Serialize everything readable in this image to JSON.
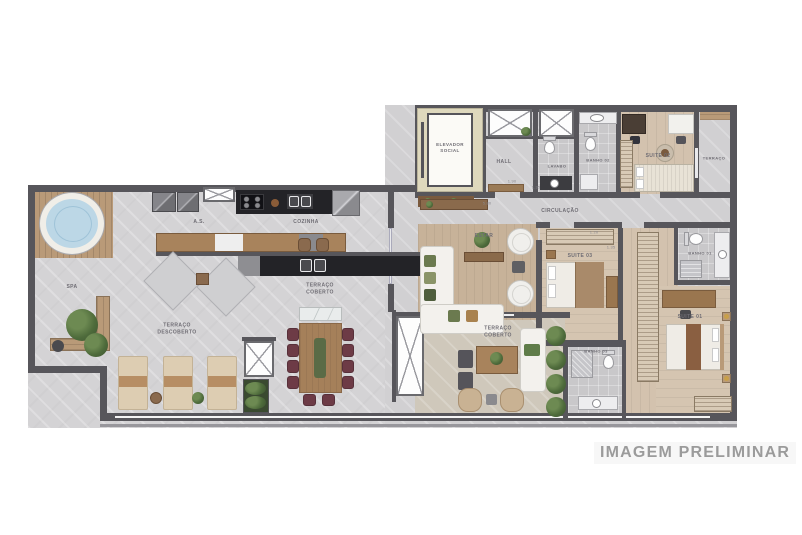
{
  "watermark": "IMAGEM PRELIMINAR",
  "rooms": {
    "elevador_social": "ELEVADOR\nSOCIAL",
    "hall": "HALL",
    "lavabo": "LAVABO",
    "banho_02": "BANHO 02",
    "suite_02": "SUITE 02",
    "terraco": "TERRAÇO",
    "circulacao": "CIRCULAÇÃO",
    "estar": "ESTAR",
    "suite_03": "SUITE 03",
    "banho_01": "BANHO 01",
    "suite_01": "SUITE 01",
    "banho_03": "BANHO 03",
    "terraco_coberto_kitchen": "TERRAÇO\nCOBERTO",
    "terraco_coberto_right": "TERRAÇO\nCOBERTO",
    "cozinha": "COZINHA",
    "area_servico": "A.S.",
    "terraco_descoberto": "TERRAÇO\nDESCOBERTO",
    "spa": "SPA"
  },
  "dimensions": {
    "d1": "1.90",
    "d2": "1.35",
    "d3": "5.80",
    "d4": "1.20",
    "d5": "1.35"
  },
  "colors": {
    "wall": "#57565b",
    "concrete_floor": "#d4d3d5",
    "wood_floor": "#d5c5b1",
    "estar_rug": "#c7b299",
    "deck_wood": "#b99a78",
    "counter_black": "#232327",
    "chair_burgundy": "#6d3b46",
    "spa_water": "#bcd7e6",
    "plant_green": "#4e6b3b",
    "watermark_gray": "#9b9b9b"
  }
}
